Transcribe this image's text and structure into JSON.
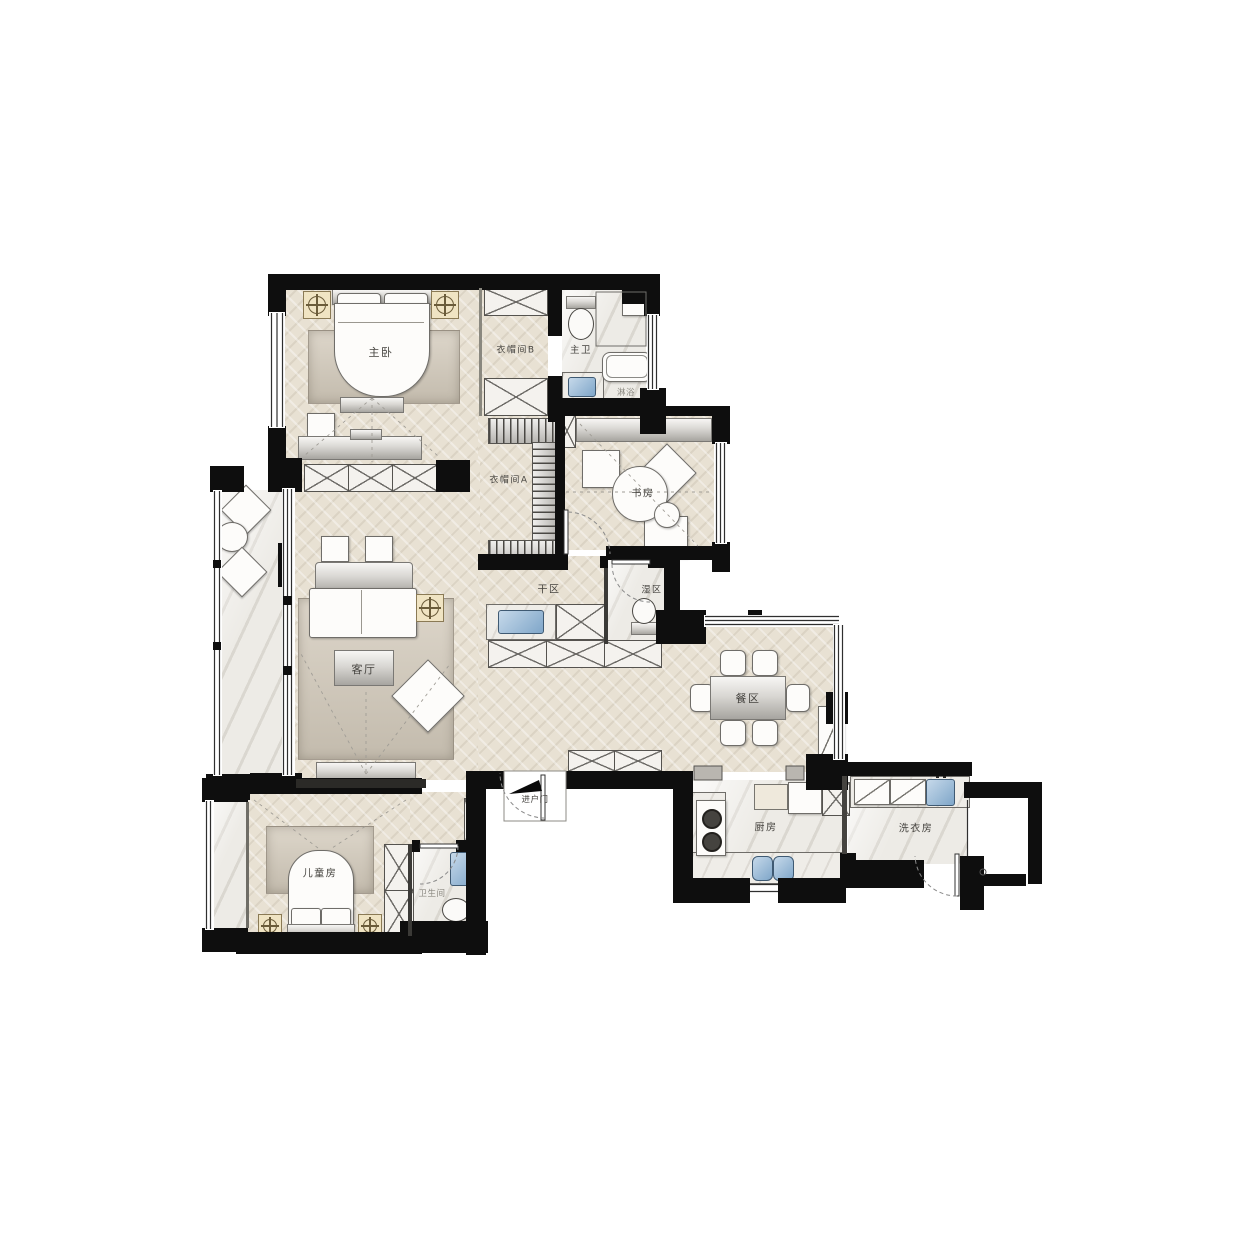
{
  "rooms": {
    "master_bedroom": {
      "label": "主卧"
    },
    "cloakroom_b": {
      "label": "衣帽间B"
    },
    "master_bathroom": {
      "label": "主卫"
    },
    "shower": {
      "label": "淋浴"
    },
    "cloakroom_a": {
      "label": "衣帽间A"
    },
    "study": {
      "label": "书房"
    },
    "dry_area": {
      "label": "干区"
    },
    "wet_area": {
      "label": "湿区"
    },
    "living_room": {
      "label": "客厅"
    },
    "dining_area": {
      "label": "餐区"
    },
    "entry_door": {
      "label": "进户门"
    },
    "kitchen": {
      "label": "厨房"
    },
    "laundry_room": {
      "label": "洗衣房"
    },
    "kids_room": {
      "label": "儿童房"
    },
    "bathroom": {
      "label": "卫生间"
    }
  },
  "colors": {
    "wall": "#0e0e0e",
    "wood_floor": "#e8e1d3",
    "marble_floor": "#edebe6",
    "sink_blue": "#7fa6c9",
    "gold_accent": "#b9995e",
    "rug": "#cdc5b7"
  }
}
